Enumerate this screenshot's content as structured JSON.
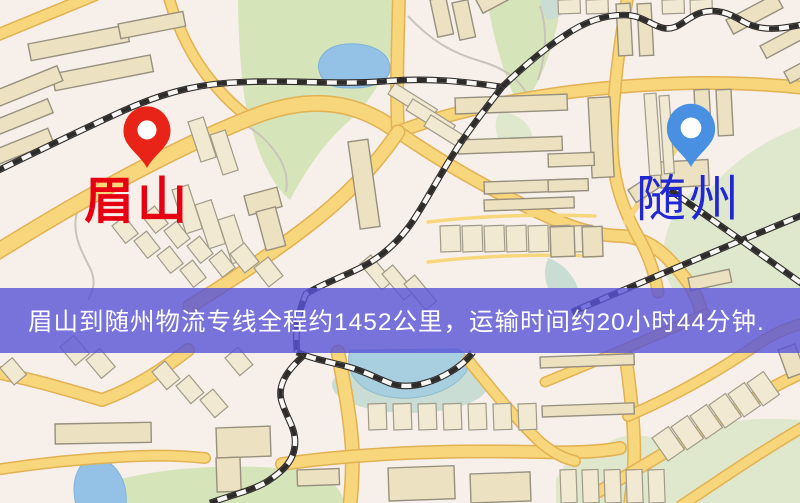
{
  "map": {
    "markers": [
      {
        "id": "origin",
        "label": "眉山",
        "pin_color": "#e82418",
        "label_color": "#e60012"
      },
      {
        "id": "destination",
        "label": "随州",
        "pin_color": "#4a90e2",
        "label_color": "#2028d4"
      }
    ]
  },
  "banner": {
    "text": "眉山到随州物流专线全程约1452公里，运输时间约20小时44分钟.",
    "background_color": "rgba(88,82,215,0.80)",
    "text_color": "#ffffff"
  },
  "palette": {
    "map_background": "#f7f0ea",
    "road_fill": "#f7d67c",
    "road_casing": "#e2b152",
    "building_fill": "#ece2c2",
    "building_stroke": "#97907e",
    "park_green": "#d6e4ba",
    "water_blue": "#93c2e6",
    "railway_dark": "#2e2c2a"
  }
}
